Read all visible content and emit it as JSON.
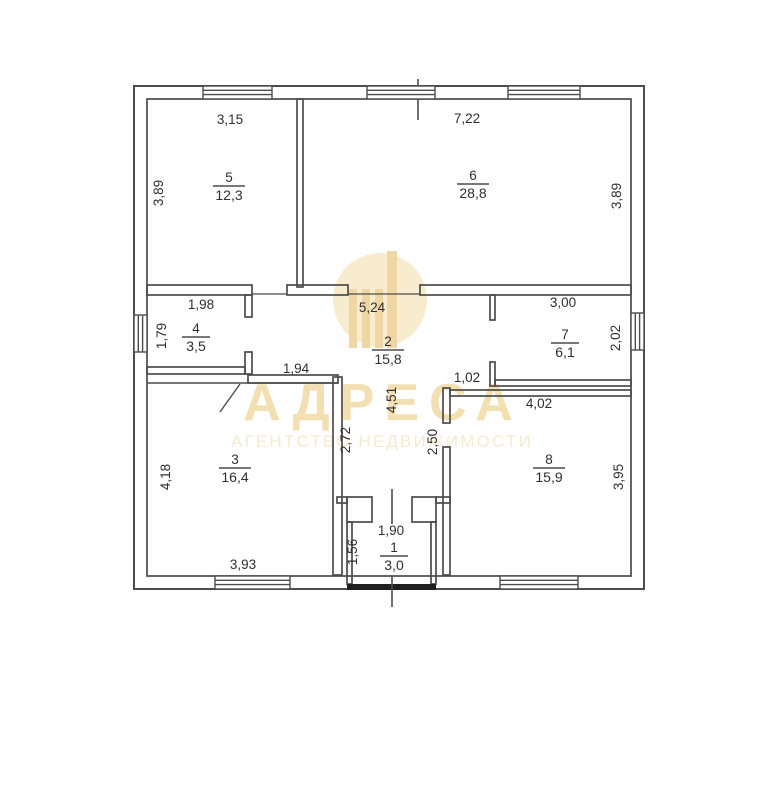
{
  "watermark": {
    "brand": "АДРЕСА",
    "tagline": "АГЕНТСТВО НЕДВИЖИМОСТИ",
    "logo": "circle-monogram",
    "gold": "#f2dfb2",
    "gold_light": "#f6ead0"
  },
  "plan": {
    "type": "floor-plan",
    "line_color": "#4c4c4c",
    "rooms": [
      {
        "number": "1",
        "area": "3,0"
      },
      {
        "number": "2",
        "area": "15,8"
      },
      {
        "number": "3",
        "area": "16,4"
      },
      {
        "number": "4",
        "area": "3,5"
      },
      {
        "number": "5",
        "area": "12,3"
      },
      {
        "number": "6",
        "area": "28,8"
      },
      {
        "number": "7",
        "area": "6,1"
      },
      {
        "number": "8",
        "area": "15,9"
      }
    ],
    "dimensions": {
      "room5_top": "3,15",
      "room6_top": "7,22",
      "room5_left": "3,89",
      "room6_right": "3,89",
      "room4_top": "1,98",
      "hall_top": "5,24",
      "room7_top": "3,00",
      "room4_left": "1,79",
      "room7_right": "2,02",
      "wall_above_room3": "1,94",
      "wall_above_room8": "1,02",
      "hall_height": "4,51",
      "hall_left_height": "2,72",
      "hall_right_height": "2,50",
      "room8_top": "4,02",
      "room3_left": "4,18",
      "room8_right": "3,95",
      "room3_bottom": "3,93",
      "room1_top": "1,90",
      "room1_left": "1,56"
    }
  }
}
